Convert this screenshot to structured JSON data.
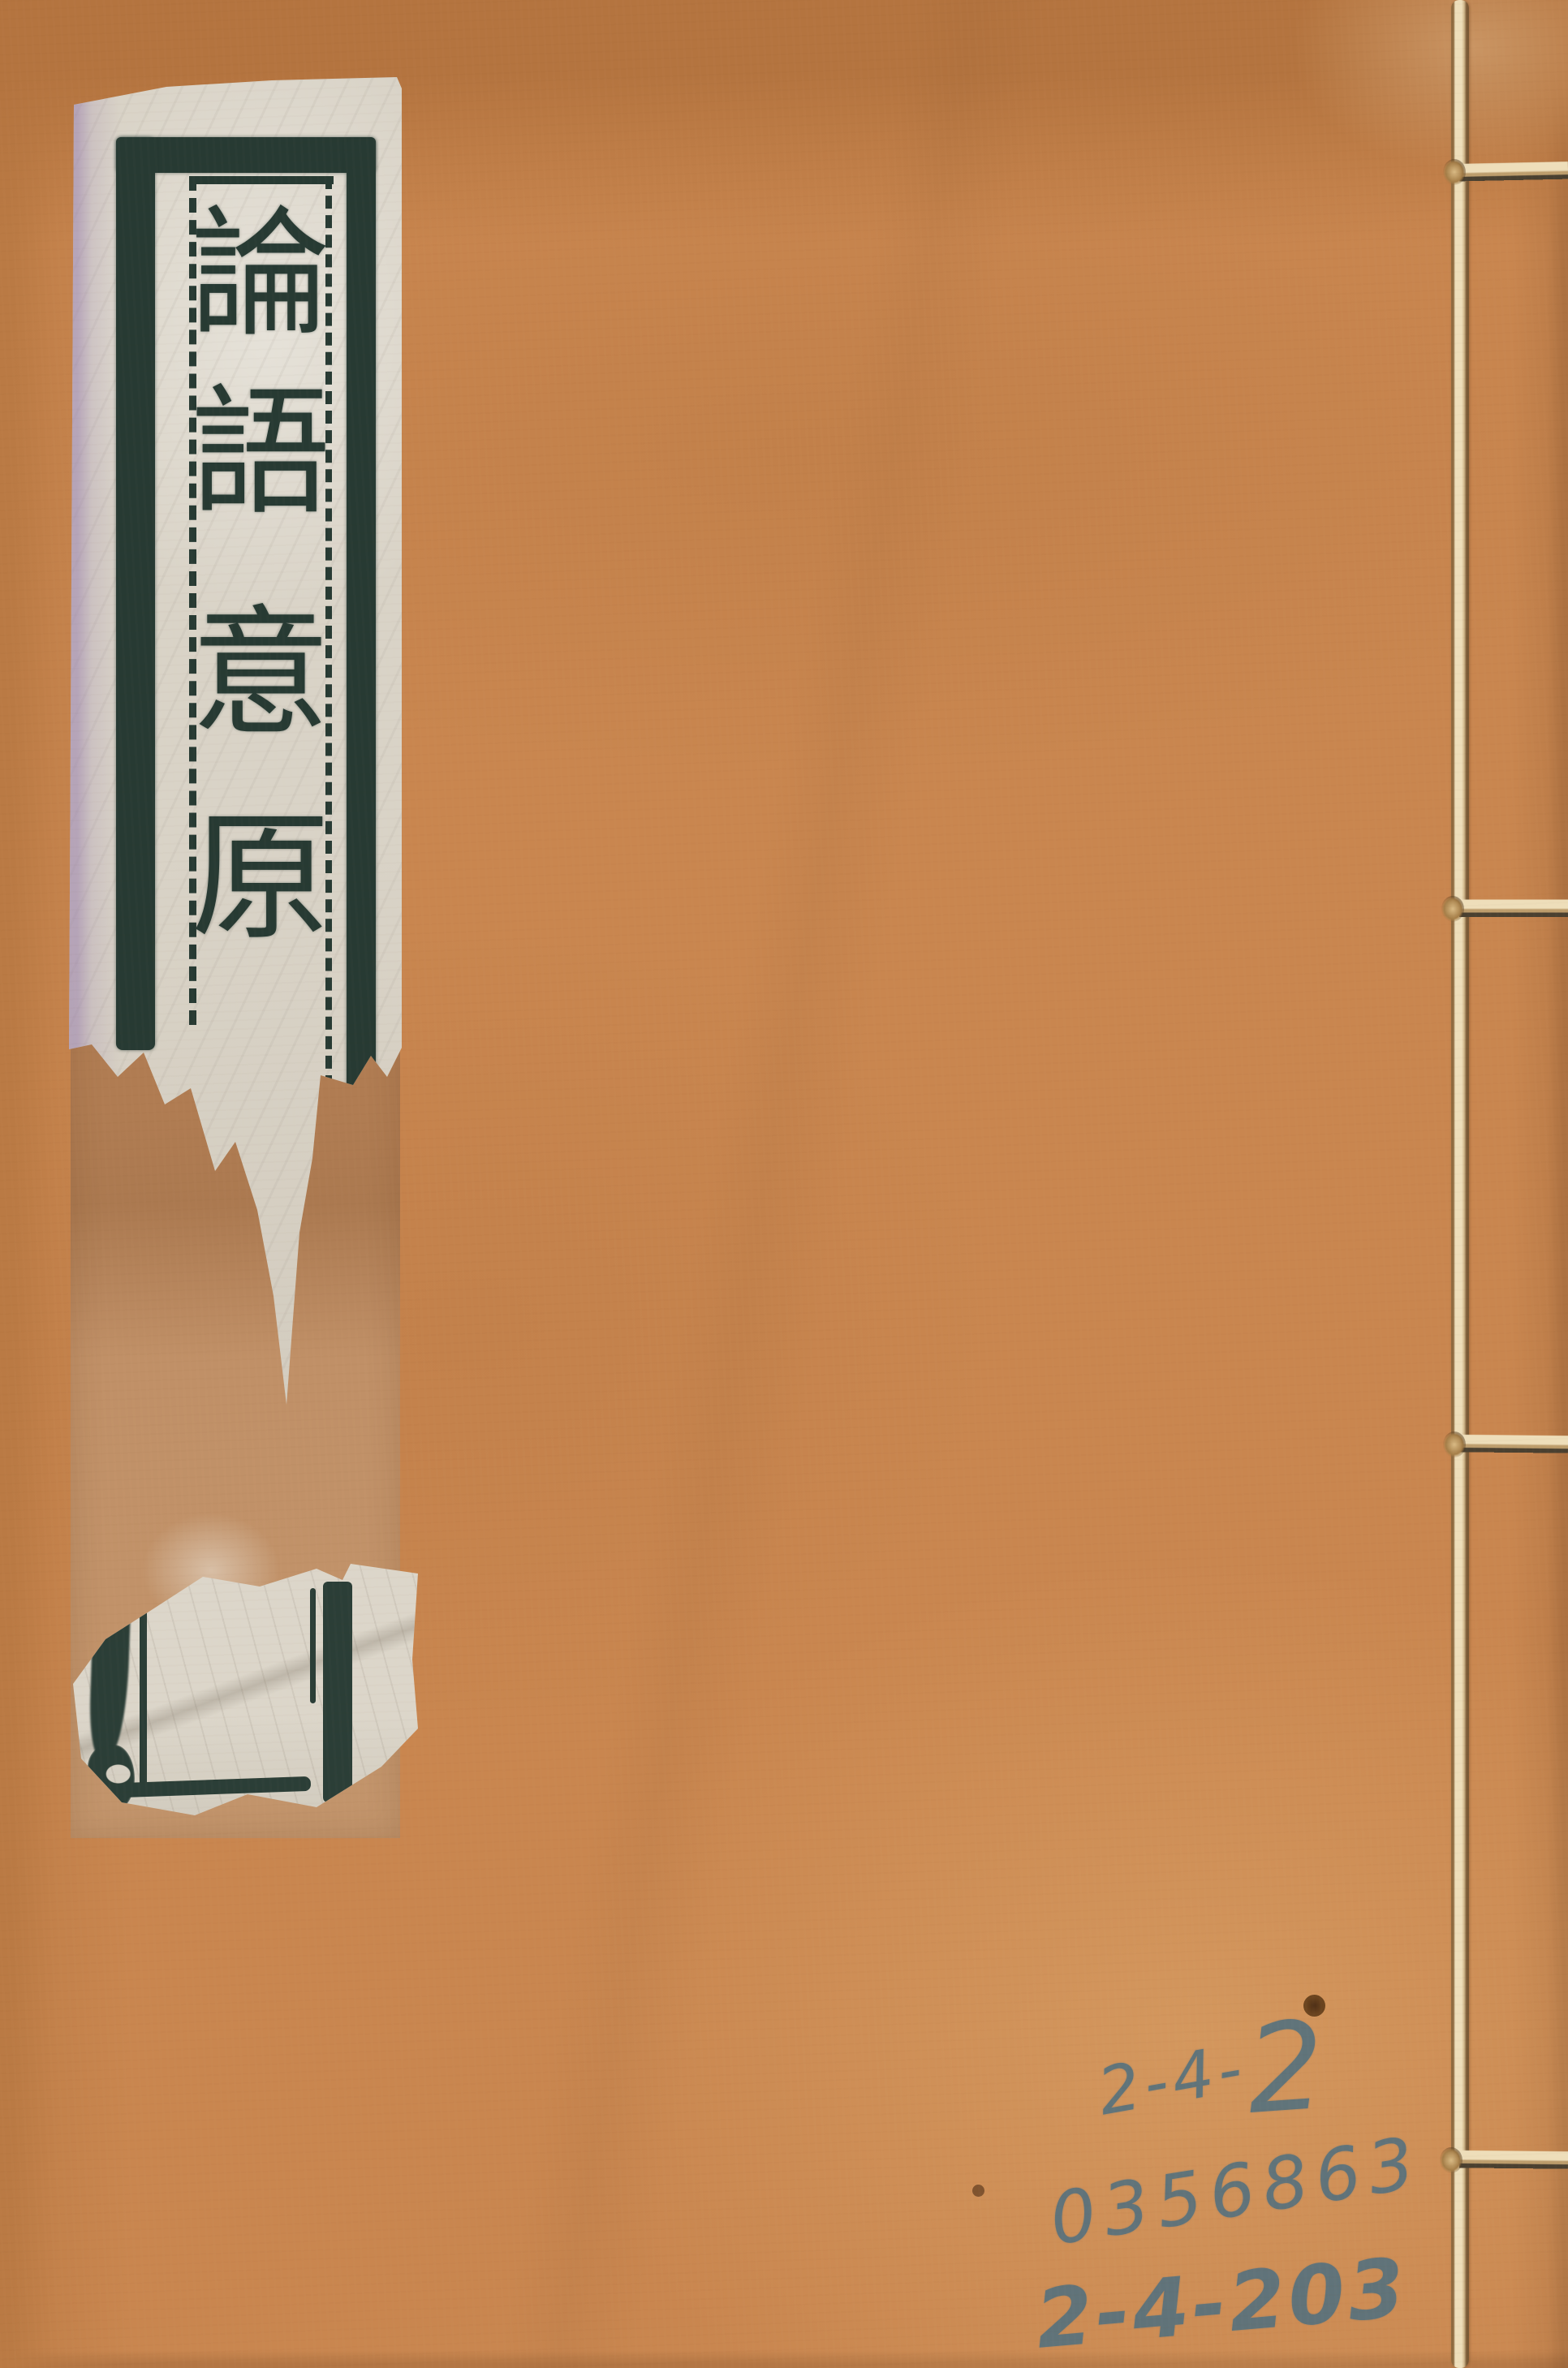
{
  "cover": {
    "description": "Thread-bound Chinese book front cover",
    "background_color": "#c9864f"
  },
  "title_label": {
    "title": "論語意原",
    "characters": [
      "論",
      "語",
      "意",
      "原"
    ],
    "script": "seal-script woodblock label",
    "ink_color": "#273a33",
    "paper_color": "#d9d3c7"
  },
  "binding": {
    "thread_color": "#eedeba",
    "stitches": 4
  },
  "annotations": {
    "pencil_color": "#51707f",
    "line1_prefix": "2-4-",
    "line1_suffix": "2",
    "line2": "0356863",
    "line3": "2-4-203"
  }
}
